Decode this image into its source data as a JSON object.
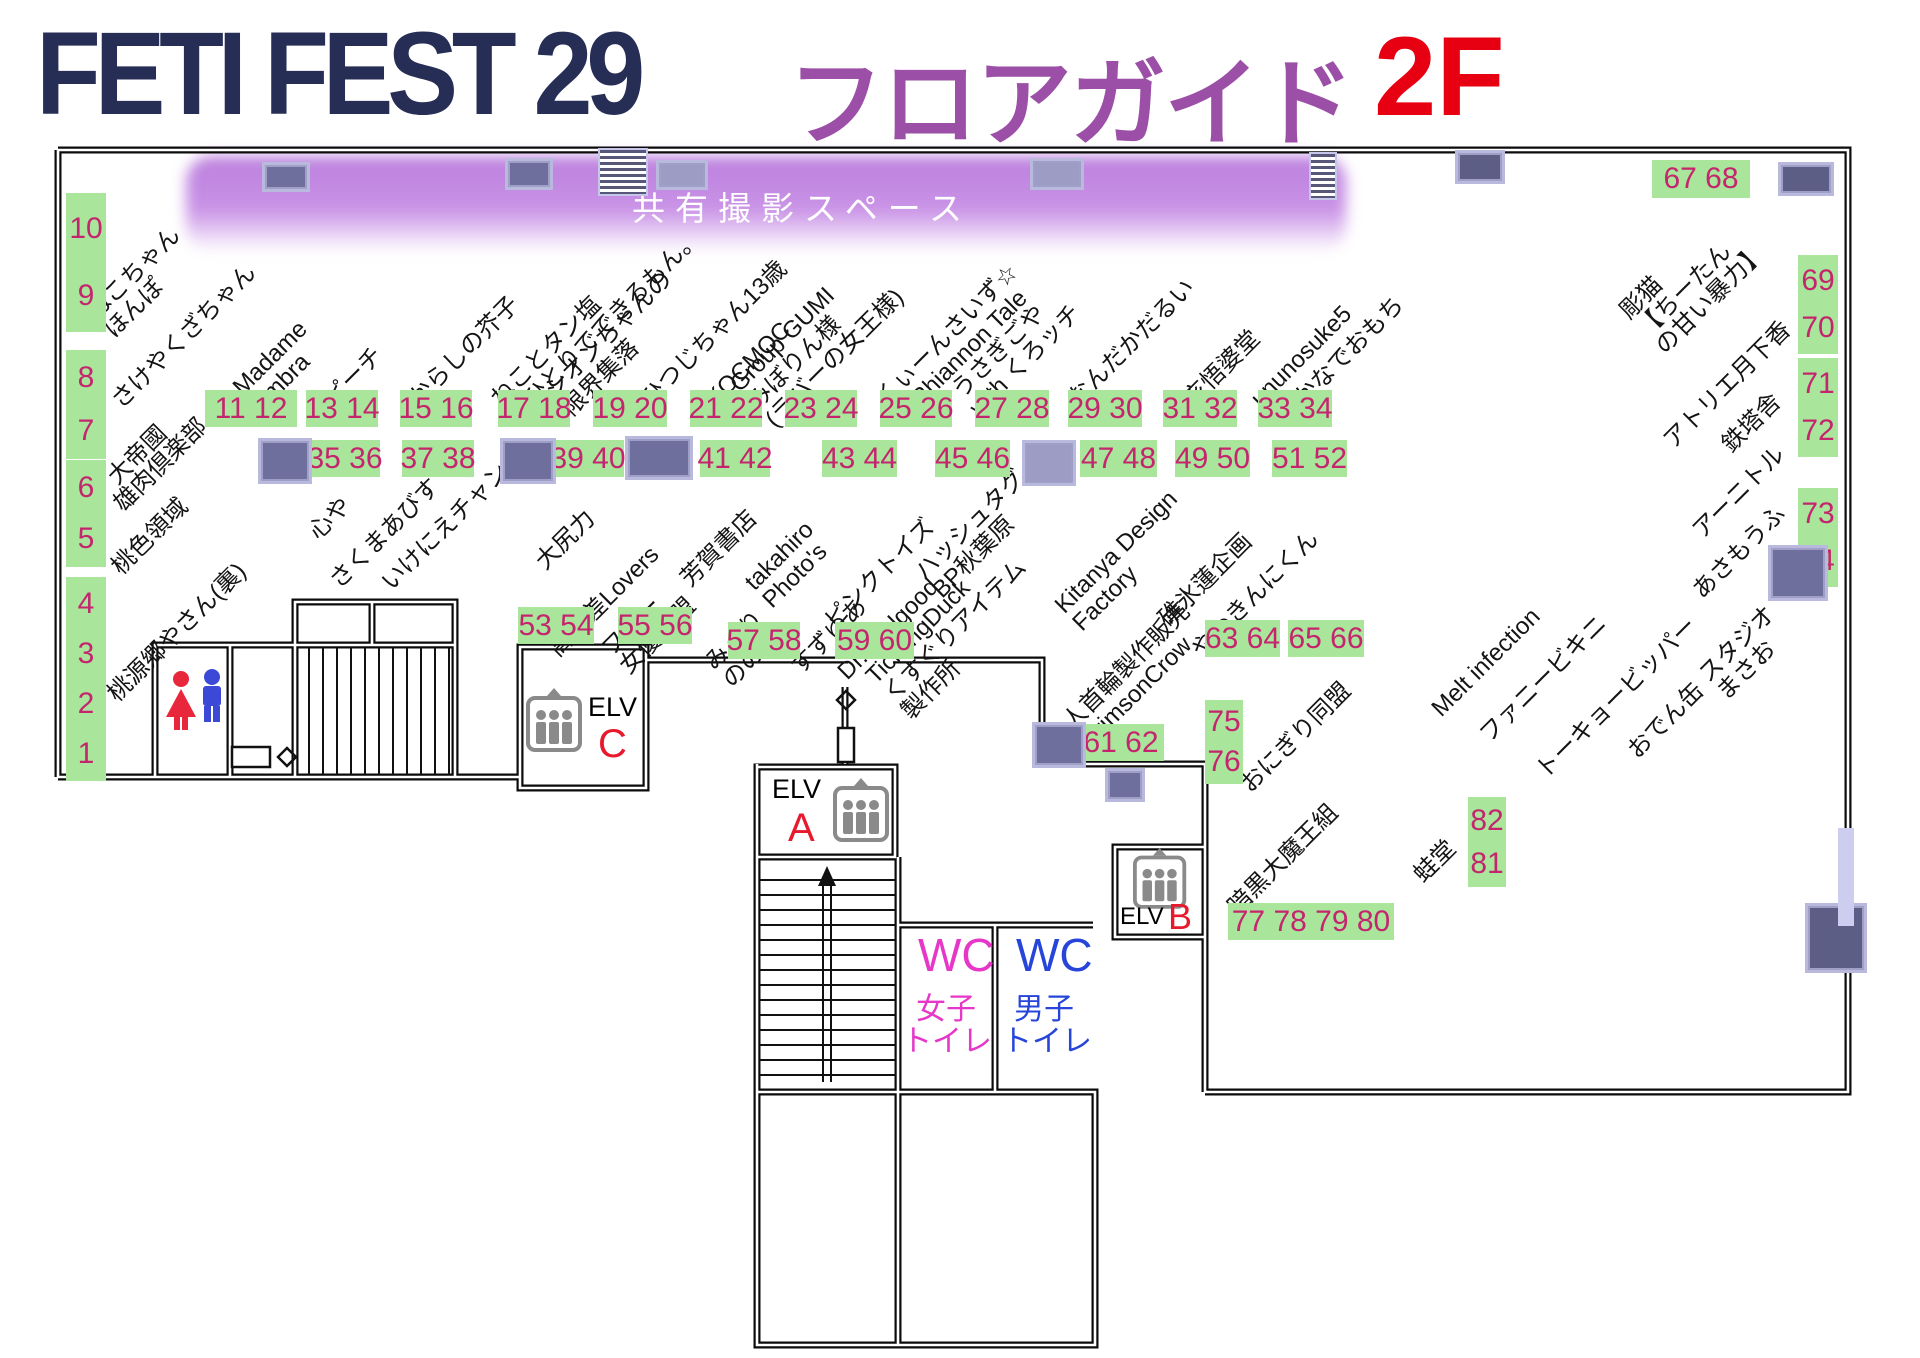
{
  "title": {
    "event": "FETI FEST 29",
    "guide": "フロアガイド",
    "floor": "2F"
  },
  "shared_space_label": "共有撮影スペース",
  "colors": {
    "booth_bg": "#a9e59b",
    "booth_number": "#c4256e",
    "title_navy": "#272e56",
    "title_purple": "#9b4fa6",
    "title_red": "#e60012",
    "band_purple": "#c48ae3",
    "wc_female": "#e637c8",
    "wc_male": "#2745d9",
    "elevator_letter": "#e8192c"
  },
  "elevators": {
    "c": {
      "label": "ELV",
      "letter": "C"
    },
    "a": {
      "label": "ELV",
      "letter": "A"
    },
    "b": {
      "label": "ELV",
      "letter": "B"
    }
  },
  "toilets": {
    "female": {
      "wc": "WC",
      "l1": "女子",
      "l2": "トイレ"
    },
    "male": {
      "wc": "WC",
      "l1": "男子",
      "l2": "トイレ"
    }
  },
  "map": {
    "booths": [
      {
        "dir": "v",
        "lines": [
          "10",
          "9"
        ],
        "x": 66,
        "y": 193,
        "w": 40,
        "h": 135
      },
      {
        "dir": "v",
        "lines": [
          "8",
          "7"
        ],
        "x": 66,
        "y": 350,
        "w": 40,
        "h": 105
      },
      {
        "dir": "v",
        "lines": [
          "6",
          "5"
        ],
        "x": 66,
        "y": 460,
        "w": 40,
        "h": 103
      },
      {
        "dir": "v",
        "lines": [
          "4",
          "3",
          "2",
          "1"
        ],
        "x": 66,
        "y": 577,
        "w": 40,
        "h": 200
      },
      {
        "text": "11 12",
        "x": 205,
        "y": 390,
        "w": 92,
        "h": 37
      },
      {
        "text": "13 14",
        "x": 306,
        "y": 390,
        "w": 72,
        "h": 37
      },
      {
        "text": "15 16",
        "x": 400,
        "y": 390,
        "w": 72,
        "h": 37
      },
      {
        "text": "17 18",
        "x": 498,
        "y": 390,
        "w": 72,
        "h": 37
      },
      {
        "text": "19 20",
        "x": 593,
        "y": 390,
        "w": 74,
        "h": 37
      },
      {
        "text": "21 22",
        "x": 690,
        "y": 390,
        "w": 72,
        "h": 37
      },
      {
        "text": "23 24",
        "x": 785,
        "y": 390,
        "w": 72,
        "h": 37
      },
      {
        "text": "25 26",
        "x": 880,
        "y": 390,
        "w": 72,
        "h": 37
      },
      {
        "text": "27 28",
        "x": 975,
        "y": 390,
        "w": 74,
        "h": 37
      },
      {
        "text": "29 30",
        "x": 1068,
        "y": 390,
        "w": 74,
        "h": 37
      },
      {
        "text": "31 32",
        "x": 1163,
        "y": 390,
        "w": 74,
        "h": 37
      },
      {
        "text": "33 34",
        "x": 1258,
        "y": 390,
        "w": 74,
        "h": 37
      },
      {
        "text": "35 36",
        "x": 310,
        "y": 440,
        "w": 70,
        "h": 37
      },
      {
        "text": "37 38",
        "x": 402,
        "y": 440,
        "w": 72,
        "h": 37
      },
      {
        "text": "39 40",
        "x": 552,
        "y": 440,
        "w": 72,
        "h": 37
      },
      {
        "text": "41 42",
        "x": 700,
        "y": 440,
        "w": 70,
        "h": 37
      },
      {
        "text": "43 44",
        "x": 822,
        "y": 440,
        "w": 75,
        "h": 37
      },
      {
        "text": "45 46",
        "x": 935,
        "y": 440,
        "w": 75,
        "h": 37
      },
      {
        "text": "47 48",
        "x": 1080,
        "y": 440,
        "w": 77,
        "h": 37
      },
      {
        "text": "49 50",
        "x": 1175,
        "y": 440,
        "w": 75,
        "h": 37
      },
      {
        "text": "51 52",
        "x": 1272,
        "y": 440,
        "w": 75,
        "h": 37
      },
      {
        "text": "53 54",
        "x": 518,
        "y": 607,
        "w": 76,
        "h": 37
      },
      {
        "text": "55 56",
        "x": 618,
        "y": 607,
        "w": 74,
        "h": 37
      },
      {
        "text": "57 58",
        "x": 728,
        "y": 622,
        "w": 72,
        "h": 37
      },
      {
        "text": "59 60",
        "x": 835,
        "y": 622,
        "w": 79,
        "h": 37
      },
      {
        "text": "61 62",
        "x": 1078,
        "y": 724,
        "w": 86,
        "h": 37
      },
      {
        "text": "63 64",
        "x": 1205,
        "y": 620,
        "w": 75,
        "h": 37
      },
      {
        "text": "65 66",
        "x": 1288,
        "y": 620,
        "w": 76,
        "h": 37
      },
      {
        "text": "67 68",
        "x": 1652,
        "y": 160,
        "w": 98,
        "h": 38
      },
      {
        "dir": "v",
        "lines": [
          "69",
          "70"
        ],
        "x": 1798,
        "y": 255,
        "w": 40,
        "h": 95
      },
      {
        "dir": "v",
        "lines": [
          "71",
          "72"
        ],
        "x": 1798,
        "y": 358,
        "w": 40,
        "h": 95
      },
      {
        "dir": "v",
        "lines": [
          "73",
          "74"
        ],
        "x": 1798,
        "y": 488,
        "w": 40,
        "h": 95
      },
      {
        "dir": "v",
        "lines": [
          "75",
          "76"
        ],
        "x": 1205,
        "y": 700,
        "w": 38,
        "h": 80
      },
      {
        "dir": "v",
        "lines": [
          "82",
          "81"
        ],
        "x": 1468,
        "y": 797,
        "w": 38,
        "h": 86
      },
      {
        "text": "77 78 79 80",
        "x": 1228,
        "y": 903,
        "w": 166,
        "h": 37
      }
    ],
    "circle_names": [
      {
        "lines": [
          "ねこちゃん",
          "ほんぽ"
        ],
        "x": 100,
        "y": 300
      },
      {
        "lines": [
          "さけやくざちゃん"
        ],
        "x": 116,
        "y": 392
      },
      {
        "lines": [
          "大帝國"
        ],
        "x": 112,
        "y": 468
      },
      {
        "lines": [
          "雄肉倶楽部"
        ],
        "x": 118,
        "y": 495
      },
      {
        "lines": [
          "桃色領域"
        ],
        "x": 116,
        "y": 558
      },
      {
        "lines": [
          "桃源郷やさん(裏)"
        ],
        "x": 112,
        "y": 685
      },
      {
        "lines": [
          "Madame",
          "Umbra"
        ],
        "x": 246,
        "y": 375
      },
      {
        "lines": [
          "ピーチ"
        ],
        "x": 328,
        "y": 390
      },
      {
        "lines": [
          "からしの芥子"
        ],
        "x": 413,
        "y": 390
      },
      {
        "lines": [
          "ねことタン塩"
        ],
        "x": 495,
        "y": 390
      },
      {
        "lines": [
          "ひとりでできるもん。"
        ],
        "x": 528,
        "y": 390
      },
      {
        "lines": [
          "シオンちゃんの",
          "限界集落"
        ],
        "x": 558,
        "y": 378
      },
      {
        "lines": [
          "ひつじちゃん13歳"
        ],
        "x": 645,
        "y": 390
      },
      {
        "lines": [
          "KOCMOC"
        ],
        "x": 710,
        "y": 390
      },
      {
        "lines": [
          "Group GUMI",
          "みぼりん様",
          "(ラバーの女王様)"
        ],
        "x": 752,
        "y": 368
      },
      {
        "lines": [
          "くぃーんさいず☆"
        ],
        "x": 880,
        "y": 390
      },
      {
        "lines": [
          "Rhiannon Tale"
        ],
        "x": 915,
        "y": 390
      },
      {
        "lines": [
          "うさぎごや",
          "with くろッチ"
        ],
        "x": 965,
        "y": 378
      },
      {
        "lines": [
          "なんだかだるい"
        ],
        "x": 1072,
        "y": 390
      },
      {
        "lines": [
          "亥悟婆堂"
        ],
        "x": 1188,
        "y": 390
      },
      {
        "lines": [
          "ununosuke5"
        ],
        "x": 1255,
        "y": 390
      },
      {
        "lines": [
          "かなでおもち"
        ],
        "x": 1298,
        "y": 390
      },
      {
        "lines": [
          "彫猫",
          "【ちーたん",
          "の甘い暴力】"
        ],
        "x": 1642,
        "y": 295
      },
      {
        "lines": [
          "アトリエ月下香"
        ],
        "x": 1668,
        "y": 432
      },
      {
        "lines": [
          "鉄塔舎"
        ],
        "x": 1726,
        "y": 436
      },
      {
        "lines": [
          "アーニトル"
        ],
        "x": 1697,
        "y": 522
      },
      {
        "lines": [
          "あさもうふ"
        ],
        "x": 1697,
        "y": 582
      },
      {
        "lines": [
          "スタジオ",
          "まさお"
        ],
        "x": 1712,
        "y": 662
      },
      {
        "lines": [
          "おでん缶"
        ],
        "x": 1632,
        "y": 742
      },
      {
        "lines": [
          "トーキョービッパー"
        ],
        "x": 1540,
        "y": 762
      },
      {
        "lines": [
          "ファニービキニ"
        ],
        "x": 1484,
        "y": 726
      },
      {
        "lines": [
          "Melt infection"
        ],
        "x": 1436,
        "y": 700
      },
      {
        "lines": [
          "心や"
        ],
        "x": 313,
        "y": 523
      },
      {
        "lines": [
          "さくまあびす"
        ],
        "x": 334,
        "y": 572
      },
      {
        "lines": [
          "いけにえチャン"
        ],
        "x": 386,
        "y": 574
      },
      {
        "lines": [
          "大尻力"
        ],
        "x": 540,
        "y": 553
      },
      {
        "lines": [
          "高低差Lovers"
        ],
        "x": 553,
        "y": 640
      },
      {
        "lines": [
          "フリー",
          "女優連盟"
        ],
        "x": 615,
        "y": 636
      },
      {
        "lines": [
          "芳賀書店"
        ],
        "x": 685,
        "y": 570
      },
      {
        "lines": [
          "みくり",
          "ののか"
        ],
        "x": 718,
        "y": 650
      },
      {
        "lines": [
          "すずゆあ"
        ],
        "x": 795,
        "y": 658
      },
      {
        "lines": [
          "takahiro",
          "Photo's"
        ],
        "x": 758,
        "y": 570
      },
      {
        "lines": [
          "ピンクトイズ"
        ],
        "x": 829,
        "y": 612
      },
      {
        "lines": [
          "Dr.Feelgood"
        ],
        "x": 842,
        "y": 663
      },
      {
        "lines": [
          "TicklingDuck",
          "くすぐりアイテム",
          "製作所"
        ],
        "x": 888,
        "y": 660
      },
      {
        "lines": [
          "ハッシュタグ",
          "BP秋葉原"
        ],
        "x": 928,
        "y": 560
      },
      {
        "lines": [
          "Kitanya Design",
          "Factory"
        ],
        "x": 1068,
        "y": 593
      },
      {
        "lines": [
          "碓氷蓮企画"
        ],
        "x": 1163,
        "y": 610
      },
      {
        "lines": [
          "やわきんにくん"
        ],
        "x": 1196,
        "y": 641
      },
      {
        "lines": [
          "人首輪製作販売",
          "CrimsonCrow"
        ],
        "x": 1076,
        "y": 710
      },
      {
        "lines": [
          "おにぎり同盟"
        ],
        "x": 1245,
        "y": 776
      },
      {
        "lines": [
          "暗黒大魔王組"
        ],
        "x": 1232,
        "y": 898
      },
      {
        "lines": [
          "蛙堂"
        ],
        "x": 1418,
        "y": 866
      }
    ],
    "pillars": [
      {
        "x": 262,
        "y": 162,
        "w": 42,
        "h": 24,
        "v": "p"
      },
      {
        "x": 505,
        "y": 158,
        "w": 42,
        "h": 26,
        "v": "p"
      },
      {
        "x": 598,
        "y": 148,
        "w": 46,
        "h": 44,
        "v": "h"
      },
      {
        "x": 656,
        "y": 160,
        "w": 46,
        "h": 24,
        "v": "lp"
      },
      {
        "x": 1030,
        "y": 158,
        "w": 48,
        "h": 26,
        "v": "lp"
      },
      {
        "x": 1309,
        "y": 152,
        "w": 24,
        "h": 44,
        "v": "h"
      },
      {
        "x": 1455,
        "y": 150,
        "w": 44,
        "h": 28,
        "v": "n"
      },
      {
        "x": 1778,
        "y": 162,
        "w": 50,
        "h": 28,
        "v": "n"
      },
      {
        "x": 258,
        "y": 438,
        "w": 48,
        "h": 40,
        "v": "p"
      },
      {
        "x": 500,
        "y": 438,
        "w": 50,
        "h": 40,
        "v": "p"
      },
      {
        "x": 625,
        "y": 436,
        "w": 62,
        "h": 38,
        "v": "p"
      },
      {
        "x": 1022,
        "y": 440,
        "w": 48,
        "h": 40,
        "v": "lp"
      },
      {
        "x": 1768,
        "y": 545,
        "w": 54,
        "h": 50,
        "v": "p"
      },
      {
        "x": 1032,
        "y": 722,
        "w": 48,
        "h": 40,
        "v": "p"
      },
      {
        "x": 1105,
        "y": 768,
        "w": 34,
        "h": 28,
        "v": "p"
      },
      {
        "x": 1805,
        "y": 903,
        "w": 56,
        "h": 64,
        "v": "n"
      },
      {
        "x": 1838,
        "y": 828,
        "w": 16,
        "h": 98,
        "v": "strip"
      }
    ]
  }
}
